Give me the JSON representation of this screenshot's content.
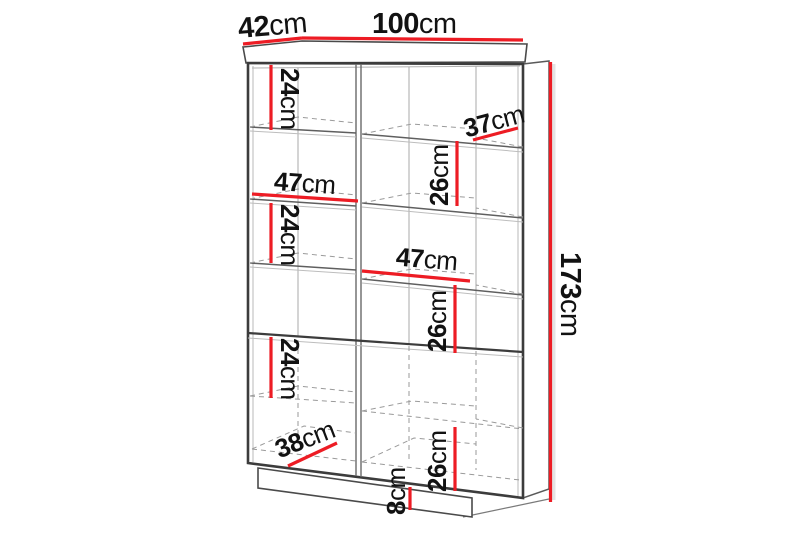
{
  "title": "Furniture dimension diagram",
  "subject": "Tall two-column display cabinet with open shelves, lower doors and plinth",
  "units": "cm",
  "colors": {
    "dimension_line": "#ed1c24",
    "outline": "#3c3c3c",
    "hidden_line": "#9a9a9a",
    "background": "#ffffff",
    "text": "#121212"
  },
  "dimensions": {
    "depth": {
      "value": "42",
      "unit": "cm"
    },
    "width": {
      "value": "100",
      "unit": "cm"
    },
    "height": {
      "value": "173",
      "unit": "cm"
    },
    "shelf_depth_upper": {
      "value": "37",
      "unit": "cm"
    },
    "interior_width_left": {
      "value": "47",
      "unit": "cm"
    },
    "interior_width_right": {
      "value": "47",
      "unit": "cm"
    },
    "left_cell_1": {
      "value": "24",
      "unit": "cm"
    },
    "left_cell_2": {
      "value": "24",
      "unit": "cm"
    },
    "left_cell_3": {
      "value": "24",
      "unit": "cm"
    },
    "right_cell_1": {
      "value": "26",
      "unit": "cm"
    },
    "right_cell_2": {
      "value": "26",
      "unit": "cm"
    },
    "right_cell_3": {
      "value": "26",
      "unit": "cm"
    },
    "interior_depth_lower": {
      "value": "38",
      "unit": "cm"
    },
    "plinth_height": {
      "value": "8",
      "unit": "cm"
    }
  }
}
